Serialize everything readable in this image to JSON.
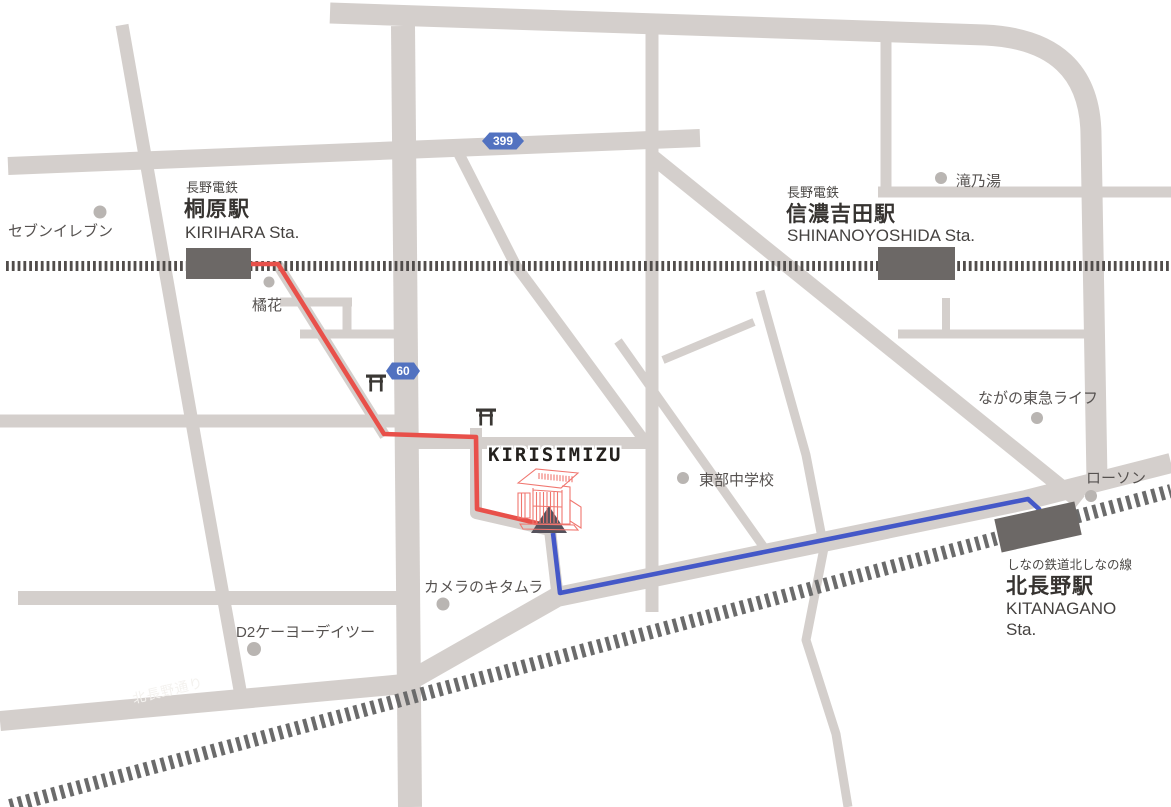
{
  "destination": {
    "label": "KIRISIMIZU"
  },
  "badges": {
    "route399": "399",
    "route60": "60"
  },
  "stations": {
    "kirihara": {
      "company": "長野電鉄",
      "name": "桐原駅",
      "romaji": "KIRIHARA Sta."
    },
    "shinanoyoshida": {
      "company": "長野電鉄",
      "name": "信濃吉田駅",
      "romaji": "SHINANOYOSHIDA Sta."
    },
    "kitanagano": {
      "line": "しなの鉄道北しなの線",
      "name": "北長野駅",
      "romaji1": "KITANAGANO",
      "romaji2": "Sta."
    }
  },
  "pois": {
    "seven_eleven": "セブンイレブン",
    "kikka": "橘花",
    "takinoyu": "滝乃湯",
    "tokyu_life": "ながの東急ライフ",
    "lawson": "ローソン",
    "tobu_junior_high": "東部中学校",
    "camera_kitamura": "カメラのキタムラ",
    "d2_keiyo": "D2ケーヨーデイツー"
  },
  "street": {
    "name": "北長野通り"
  },
  "routes": {
    "red": {
      "color": "#e8504a",
      "description": "walking route from KIRIHARA Sta."
    },
    "blue": {
      "color": "#4458c8",
      "description": "walking route from KITANAGANO Sta."
    }
  },
  "colors": {
    "road": "#d4cfcc",
    "railway_dark": "#514d4b",
    "railway_mid": "#6b6b6b",
    "station_building": "#6c6866",
    "badge_blue": "#5272c0",
    "poi_dot": "#b9b5b2",
    "gate_red": "#f0766f",
    "arrow_gray": "#55525c"
  }
}
